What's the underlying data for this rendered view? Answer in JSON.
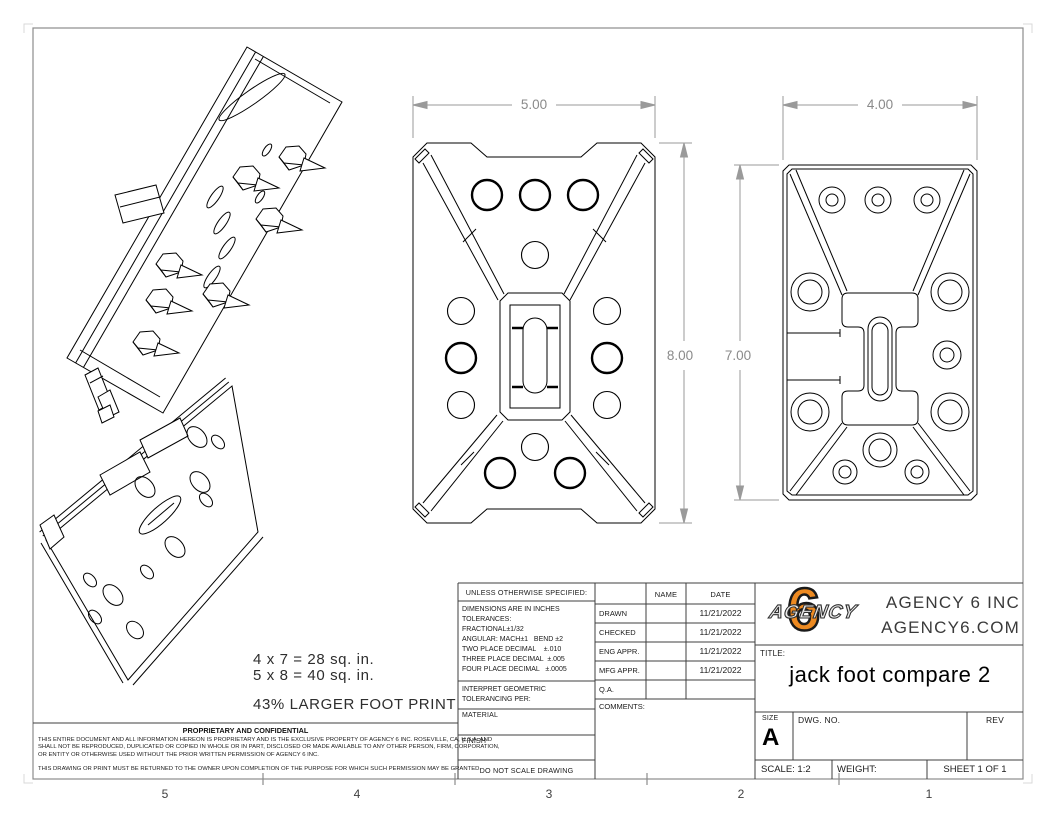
{
  "colors": {
    "accent_orange": "#ED8A21",
    "dimension_gray": "#8f8f8f",
    "line_black": "#000000",
    "border_gray": "#8c8c8c"
  },
  "zones": [
    "5",
    "4",
    "3",
    "2",
    "1"
  ],
  "dimensions": {
    "width_large": "5.00",
    "height_large": "8.00",
    "width_small": "4.00",
    "height_small": "7.00"
  },
  "notes": {
    "area_small": "4 x 7 = 28 sq. in.",
    "area_large": "5 x 8 = 40 sq. in.",
    "footprint": "43% LARGER FOOT PRINT"
  },
  "tolerance_block": {
    "header": "UNLESS OTHERWISE SPECIFIED:",
    "lines": [
      "DIMENSIONS ARE IN INCHES",
      "TOLERANCES:",
      "FRACTIONAL±1/32",
      "ANGULAR: MACH±1   BEND ±2",
      "TWO PLACE DECIMAL    ±.010",
      "THREE PLACE DECIMAL  ±.005",
      "FOUR PLACE DECIMAL   ±.0005"
    ],
    "interpret_1": "INTERPRET GEOMETRIC",
    "interpret_2": "TOLERANCING PER:",
    "material": "MATERIAL",
    "finish": "FINISH",
    "do_not_scale": "DO NOT SCALE DRAWING"
  },
  "approval": {
    "name_header": "NAME",
    "date_header": "DATE",
    "rows": [
      {
        "label": "DRAWN",
        "name": "",
        "date": "11/21/2022"
      },
      {
        "label": "CHECKED",
        "name": "",
        "date": "11/21/2022"
      },
      {
        "label": "ENG APPR.",
        "name": "",
        "date": "11/21/2022"
      },
      {
        "label": "MFG APPR.",
        "name": "",
        "date": "11/21/2022"
      },
      {
        "label": "Q.A.",
        "name": "",
        "date": ""
      }
    ],
    "comments": "COMMENTS:"
  },
  "company": {
    "line1": "AGENCY 6 INC",
    "line2": "AGENCY6.COM",
    "logo_number": "6",
    "logo_text": "AGENCY"
  },
  "titleblock": {
    "title_label": "TITLE:",
    "title": "jack foot compare 2",
    "size_label": "SIZE",
    "size": "A",
    "dwg_label": "DWG. NO.",
    "rev_label": "REV",
    "scale": "SCALE: 1:2",
    "weight": "WEIGHT:",
    "sheet": "SHEET 1 OF 1"
  },
  "proprietary": {
    "header": "PROPRIETARY AND CONFIDENTIAL",
    "line1": "THIS ENTIRE DOCUMENT AND ALL INFORMATION HEREON IS PROPRIETARY AND IS THE EXCLUSIVE PROPERTY OF AGENCY 6 INC. ROSEVILLE, CA, U.S.A. AND",
    "line2": "SHALL NOT BE REPRODUCED, DUPLICATED OR COPIED IN WHOLE OR IN PART, DISCLOSED OR MADE AVAILABLE TO ANY OTHER PERSON, FIRM, CORPORATION,",
    "line3": "OR ENTITY OR OTHERWISE USED WITHOUT THE PRIOR WRITTEN PERMISSION OF AGENCY 6 INC.",
    "line4": "THIS DRAWING OR PRINT MUST BE RETURNED TO THE OWNER UPON COMPLETION OF THE PURPOSE FOR WHICH SUCH PERMISSION MAY BE GRANTED."
  }
}
